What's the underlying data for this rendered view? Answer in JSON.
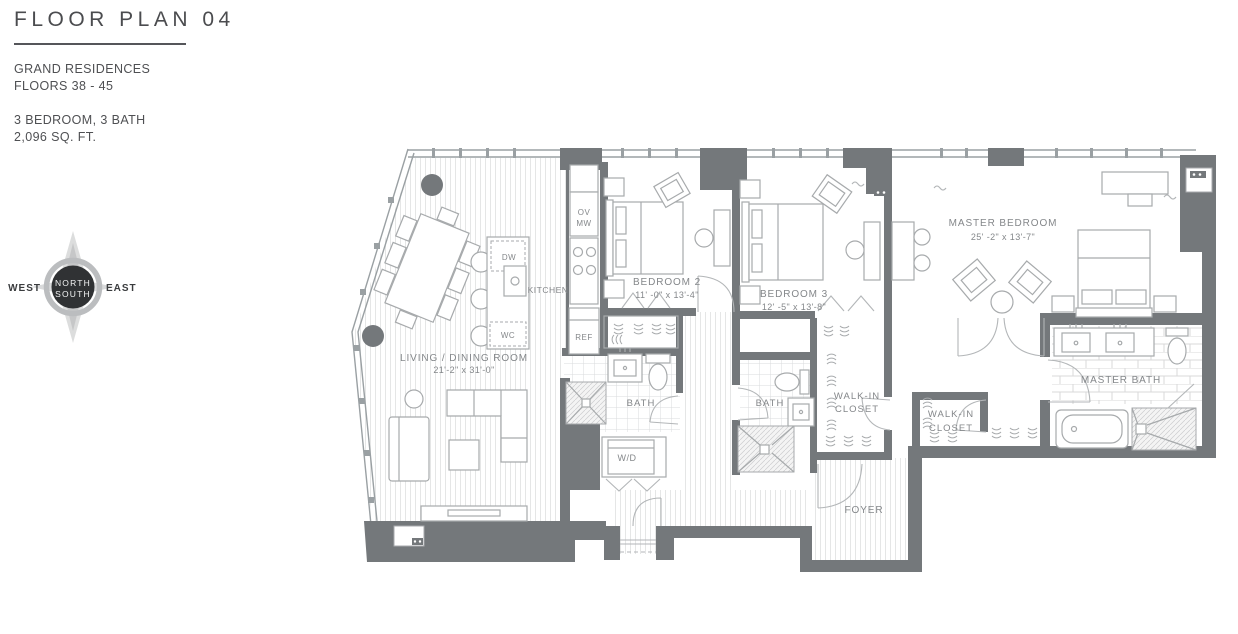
{
  "panel": {
    "title": "FLOOR PLAN 04",
    "residence": "GRAND RESIDENCES",
    "floors": "FLOORS 38 - 45",
    "config": "3 BEDROOM, 3 BATH",
    "area": "2,096 SQ. FT."
  },
  "compass": {
    "north": "NORTH",
    "south": "SOUTH",
    "east": "EAST",
    "west": "WEST"
  },
  "rooms": {
    "living": {
      "name": "LIVING / DINING ROOM",
      "dims": "21'-2\" x 31'-0\""
    },
    "kitchen": {
      "name": "KITCHEN"
    },
    "bedroom2": {
      "name": "BEDROOM 2",
      "dims": "11' -0\" x 13'-4\""
    },
    "bedroom3": {
      "name": "BEDROOM 3",
      "dims": "12' -5\" x 13'-8\""
    },
    "master": {
      "name": "MASTER BEDROOM",
      "dims": "25' -2\" x 13'-7\""
    },
    "bath2": {
      "name": "BATH"
    },
    "bath3": {
      "name": "BATH"
    },
    "wic1": {
      "line1": "WALK-IN",
      "line2": "CLOSET"
    },
    "wic2": {
      "line1": "WALK-IN",
      "line2": "CLOSET"
    },
    "masterbath": {
      "name": "MASTER BATH"
    },
    "foyer": {
      "name": "FOYER"
    }
  },
  "appliances": {
    "ov": "OV",
    "mw": "MW",
    "dw": "DW",
    "wc": "WC",
    "ref": "REF",
    "wd": "W/D"
  },
  "colors": {
    "wall": "#74787b",
    "accent_dark": "#303234",
    "label_text": "#84878a",
    "title_text": "#4b4c4f"
  }
}
